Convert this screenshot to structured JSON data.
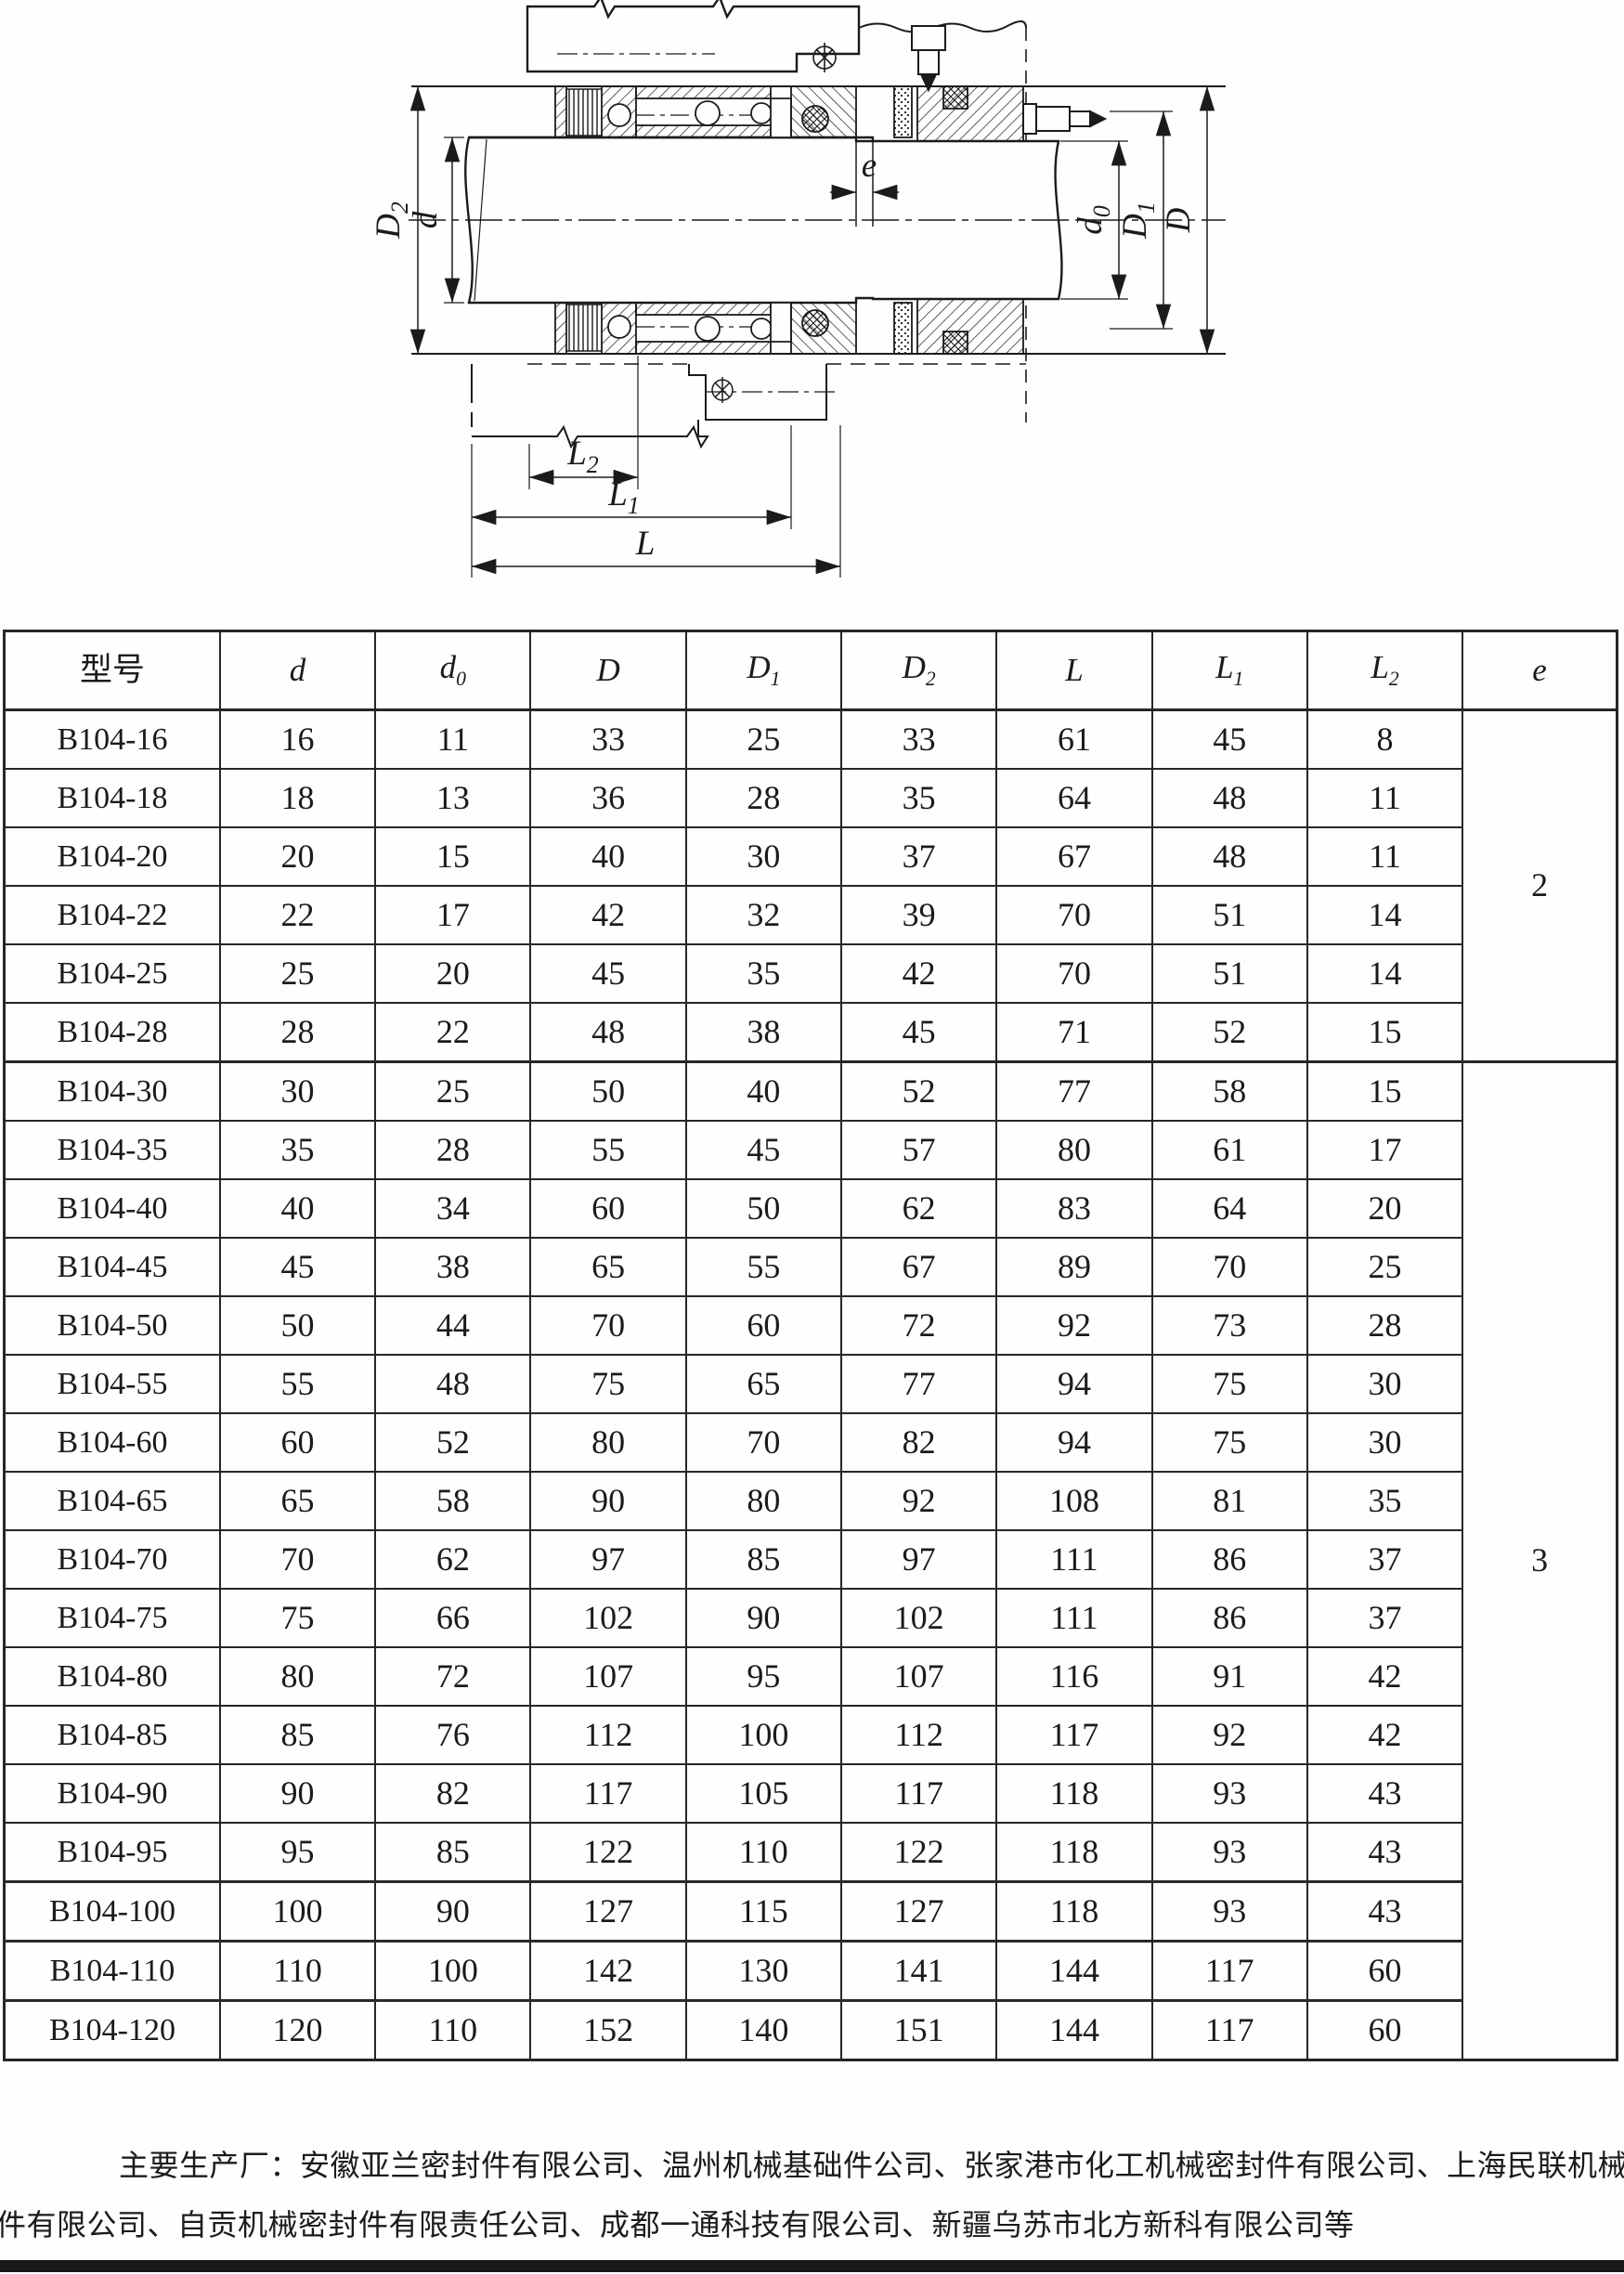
{
  "figure": {
    "title": "B104 single-spring mechanical seal cross-section",
    "labels": {
      "D2": {
        "main": "D",
        "sub": "2"
      },
      "d": {
        "main": "d",
        "sub": ""
      },
      "e": {
        "main": "e",
        "sub": ""
      },
      "d0": {
        "main": "d",
        "sub": "0"
      },
      "D1": {
        "main": "D",
        "sub": "1"
      },
      "D": {
        "main": "D",
        "sub": ""
      },
      "L2": {
        "main": "L",
        "sub": "2"
      },
      "L1": {
        "main": "L",
        "sub": "1"
      },
      "L": {
        "main": "L",
        "sub": ""
      }
    },
    "line_color": "#1b1b1b"
  },
  "table": {
    "headers": [
      {
        "text": "型号",
        "sub": "",
        "italic": false
      },
      {
        "text": "d",
        "sub": "",
        "italic": true
      },
      {
        "text": "d",
        "sub": "0",
        "italic": true
      },
      {
        "text": "D",
        "sub": "",
        "italic": true
      },
      {
        "text": "D",
        "sub": "1",
        "italic": true
      },
      {
        "text": "D",
        "sub": "2",
        "italic": true
      },
      {
        "text": "L",
        "sub": "",
        "italic": true
      },
      {
        "text": "L",
        "sub": "1",
        "italic": true
      },
      {
        "text": "L",
        "sub": "2",
        "italic": true
      },
      {
        "text": "e",
        "sub": "",
        "italic": true
      }
    ],
    "rows": [
      [
        "B104-16",
        "16",
        "11",
        "33",
        "25",
        "33",
        "61",
        "45",
        "8"
      ],
      [
        "B104-18",
        "18",
        "13",
        "36",
        "28",
        "35",
        "64",
        "48",
        "11"
      ],
      [
        "B104-20",
        "20",
        "15",
        "40",
        "30",
        "37",
        "67",
        "48",
        "11"
      ],
      [
        "B104-22",
        "22",
        "17",
        "42",
        "32",
        "39",
        "70",
        "51",
        "14"
      ],
      [
        "B104-25",
        "25",
        "20",
        "45",
        "35",
        "42",
        "70",
        "51",
        "14"
      ],
      [
        "B104-28",
        "28",
        "22",
        "48",
        "38",
        "45",
        "71",
        "52",
        "15"
      ],
      [
        "B104-30",
        "30",
        "25",
        "50",
        "40",
        "52",
        "77",
        "58",
        "15"
      ],
      [
        "B104-35",
        "35",
        "28",
        "55",
        "45",
        "57",
        "80",
        "61",
        "17"
      ],
      [
        "B104-40",
        "40",
        "34",
        "60",
        "50",
        "62",
        "83",
        "64",
        "20"
      ],
      [
        "B104-45",
        "45",
        "38",
        "65",
        "55",
        "67",
        "89",
        "70",
        "25"
      ],
      [
        "B104-50",
        "50",
        "44",
        "70",
        "60",
        "72",
        "92",
        "73",
        "28"
      ],
      [
        "B104-55",
        "55",
        "48",
        "75",
        "65",
        "77",
        "94",
        "75",
        "30"
      ],
      [
        "B104-60",
        "60",
        "52",
        "80",
        "70",
        "82",
        "94",
        "75",
        "30"
      ],
      [
        "B104-65",
        "65",
        "58",
        "90",
        "80",
        "92",
        "108",
        "81",
        "35"
      ],
      [
        "B104-70",
        "70",
        "62",
        "97",
        "85",
        "97",
        "111",
        "86",
        "37"
      ],
      [
        "B104-75",
        "75",
        "66",
        "102",
        "90",
        "102",
        "111",
        "86",
        "37"
      ],
      [
        "B104-80",
        "80",
        "72",
        "107",
        "95",
        "107",
        "116",
        "91",
        "42"
      ],
      [
        "B104-85",
        "85",
        "76",
        "112",
        "100",
        "112",
        "117",
        "92",
        "42"
      ],
      [
        "B104-90",
        "90",
        "82",
        "117",
        "105",
        "117",
        "118",
        "93",
        "43"
      ],
      [
        "B104-95",
        "95",
        "85",
        "122",
        "110",
        "122",
        "118",
        "93",
        "43"
      ],
      [
        "B104-100",
        "100",
        "90",
        "127",
        "115",
        "127",
        "118",
        "93",
        "43"
      ],
      [
        "B104-110",
        "110",
        "100",
        "142",
        "130",
        "141",
        "144",
        "117",
        "60"
      ],
      [
        "B104-120",
        "120",
        "110",
        "152",
        "140",
        "151",
        "144",
        "117",
        "60"
      ]
    ],
    "e_groups": [
      {
        "value": "2",
        "rows": 6
      },
      {
        "value": "3",
        "rows": 17
      }
    ]
  },
  "footer": {
    "line1": "主要生产厂：安徽亚兰密封件有限公司、温州机械基础件公司、张家港市化工机械密封件有限公司、上海民联机械密封",
    "line2": "件有限公司、自贡机械密封件有限责任公司、成都一通科技有限公司、新疆乌苏市北方新科有限公司等"
  }
}
